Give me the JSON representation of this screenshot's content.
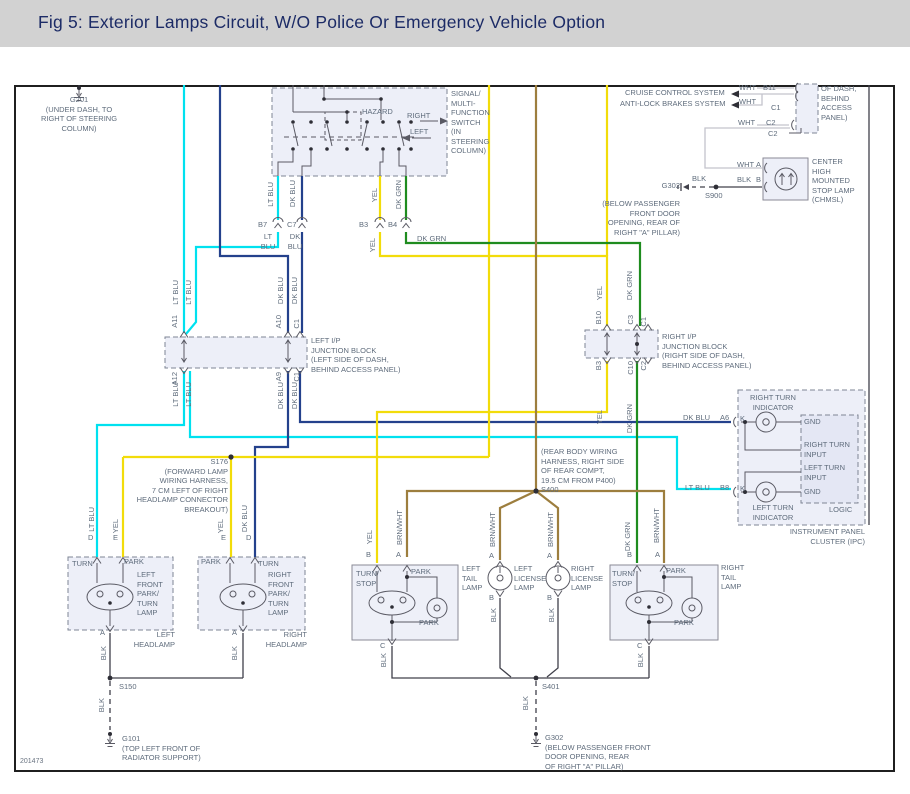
{
  "title": "Fig 5: Exterior Lamps Circuit, W/O Police Or Emergency Vehicle Option",
  "sheet_code": "201473",
  "colors": {
    "header_bg": "#d2d2d2",
    "title_text": "#1c2b66",
    "label_text": "#5f6c7c",
    "lt_blu": "#00e1ef",
    "dk_blu": "#24418c",
    "yel": "#f2dc0a",
    "dk_grn": "#1f8c1f",
    "brn_wht": "#9d7e3e",
    "blk": "#40404a",
    "wht": "#c4c4cc",
    "box_fill": "#edeff8"
  },
  "wire_names": {
    "lt_blu": "LT BLU",
    "dk_blu": "DK BLU",
    "yel": "YEL",
    "dk_grn": "DK GRN",
    "brn_wht": "BRN/WHT",
    "blk": "BLK",
    "wht": "WHT"
  },
  "pins": {
    "a": "A",
    "b": "B",
    "c": "C",
    "d": "D",
    "e": "E",
    "k": "K"
  },
  "conn": {
    "b7": "B7",
    "c7": "C7",
    "b3": "B3",
    "b4": "B4",
    "b7_wire": "LT\nBLU",
    "c7_wire": "DK\nBLU",
    "b11": "B11",
    "c1": "C1",
    "c2": "C2",
    "a6": "A6",
    "b8": "B8"
  },
  "switch": {
    "hazard": "HAZARD",
    "right": "RIGHT",
    "left": "LEFT",
    "name": "SIGNAL/\nMULTI-\nFUNCTION\nSWITCH\n(IN\nSTEERING\nCOLUMN)"
  },
  "grounds": {
    "g201": "G201\n(UNDER DASH, TO\nRIGHT OF STEERING\nCOLUMN)",
    "g101": "G101\n(TOP LEFT FRONT OF\nRADIATOR SUPPORT)",
    "g302_bottom": "G302\n(BELOW PASSENGER FRONT\nDOOR OPENING, REAR\nOF RIGHT \"A\" PILLAR)",
    "g302_top": "G302",
    "g302_top_note": "(BELOW PASSENGER\nFRONT DOOR\nOPENING, REAR OF\nRIGHT \"A\" PILLAR)"
  },
  "splices": {
    "s150": "S150",
    "s900": "S900",
    "s401": "S401",
    "s176": "S176\n(FORWARD LAMP\nWIRING HARNESS,\n7 CM LEFT OF RIGHT\nHEADLAMP CONNECTOR\nBREAKOUT)",
    "s400": "(REAR BODY WIRING\nHARNESS, RIGHT SIDE\nOF REAR COMPT,\n19.5 CM FROM P400)\nS400"
  },
  "jb_left": {
    "name": "LEFT I/P\nJUNCTION BLOCK\n(LEFT SIDE OF DASH,\nBEHIND ACCESS PANEL)",
    "pins_top": [
      "A11",
      "A10",
      "C1"
    ],
    "pins_bottom": [
      "A12",
      "A9",
      "C1"
    ]
  },
  "jb_right": {
    "name": "RIGHT I/P\nJUNCTION BLOCK\n(RIGHT SIDE OF DASH,\nBEHIND ACCESS PANEL)",
    "pins_top": [
      "B10",
      "C3",
      "C1"
    ],
    "pins_bottom": [
      "B3",
      "C10",
      "C2"
    ]
  },
  "systems": {
    "cruise": "CRUISE CONTROL SYSTEM",
    "abs": "ANTI-LOCK BRAKES SYSTEM",
    "panel_note": "OF DASH,\nBEHIND\nACCESS\nPANEL)"
  },
  "ipc": {
    "right_indicator": "RIGHT TURN\nINDICATOR",
    "left_indicator": "LEFT TURN\nINDICATOR",
    "gnd": "GND",
    "right_input": "RIGHT TURN\nINPUT",
    "left_input": "LEFT TURN\nINPUT",
    "logic": "LOGIC",
    "name": "INSTRUMENT PANEL\nCLUSTER (IPC)"
  },
  "lamps": {
    "chmsl": "CENTER\nHIGH\nMOUNTED\nSTOP LAMP\n(CHMSL)",
    "left_head": {
      "turn": "TURN",
      "park": "PARK",
      "name": "LEFT\nFRONT\nPARK/\nTURN\nLAMP",
      "title": "LEFT\nHEADLAMP"
    },
    "right_head": {
      "park": "PARK",
      "turn": "TURN",
      "name": "RIGHT\nFRONT\nPARK/\nTURN\nLAMP",
      "title": "RIGHT\nHEADLAMP"
    },
    "left_tail": {
      "turn_stop": "TURN/\nSTOP",
      "park": "PARK",
      "park2": "PARK",
      "title": "LEFT\nTAIL\nLAMP"
    },
    "right_tail": {
      "turn_stop": "TURN/\nSTOP",
      "park": "PARK",
      "park2": "PARK",
      "title": "RIGHT\nTAIL\nLAMP"
    },
    "left_license": "LEFT\nLICENSE\nLAMP",
    "right_license": "RIGHT\nLICENSE\nLAMP"
  }
}
